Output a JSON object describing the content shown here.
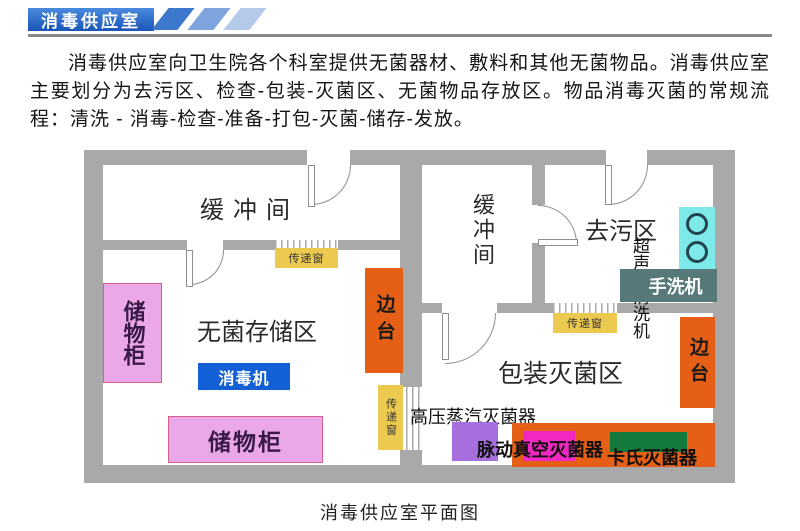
{
  "header": {
    "banner_title": "消毒供应室"
  },
  "intro": {
    "text": "消毒供应室向卫生院各个科室提供无菌器材、敷料和其他无菌物品。消毒供应室主要划分为去污区、检查-包装-灭菌区、无菌物品存放区。物品消毒灭菌的常规流程：清洗 - 消毒-检查-准备-打包-灭菌-储存-发放。"
  },
  "floorplan": {
    "rooms": {
      "buffer_left": "缓冲间",
      "buffer_mid": "缓冲间",
      "decontamination": "去污区",
      "sterile_storage": "无菌存储区",
      "packaging": "包装灭菌区"
    },
    "items": {
      "storage_cabinet_vertical": "储物柜",
      "storage_cabinet_horizontal": "储物柜",
      "disinfector": "消毒机",
      "side_bench_left": "边台",
      "side_bench_right": "边台",
      "pass_window_left": "传递窗",
      "pass_window_top": "传递窗",
      "pass_window_mid": "传递窗",
      "ultrasonic_cleaner": "超声波清洗机",
      "hand_washer": "手洗机",
      "steam_sterilizer": "高压蒸汽灭菌器",
      "pulse_vacuum_sterilizer": "脉动真空灭菌器",
      "cassette_sterilizer": "卡氏灭菌器"
    },
    "caption": "消毒供应室平面图"
  },
  "colors": {
    "banner_blue": "#1a55b8",
    "stripe_blue_1": "#3c78cc",
    "stripe_blue_2": "#7fa3dc",
    "stripe_blue_3": "#b5c9e8",
    "wall_gray": "#a9a9a9",
    "pass_window_yellow": "#ecc94f",
    "bench_orange": "#e55f17",
    "cabinet_pink": "#eaa8e8",
    "disinfector_blue": "#135fd6",
    "sink_cyan": "#7de9e9",
    "hand_washer_slate": "#567878",
    "steam_sterilizer_purple": "#a76ede",
    "pulse_magenta": "#f327c2",
    "cassette_green": "#157a3d"
  }
}
